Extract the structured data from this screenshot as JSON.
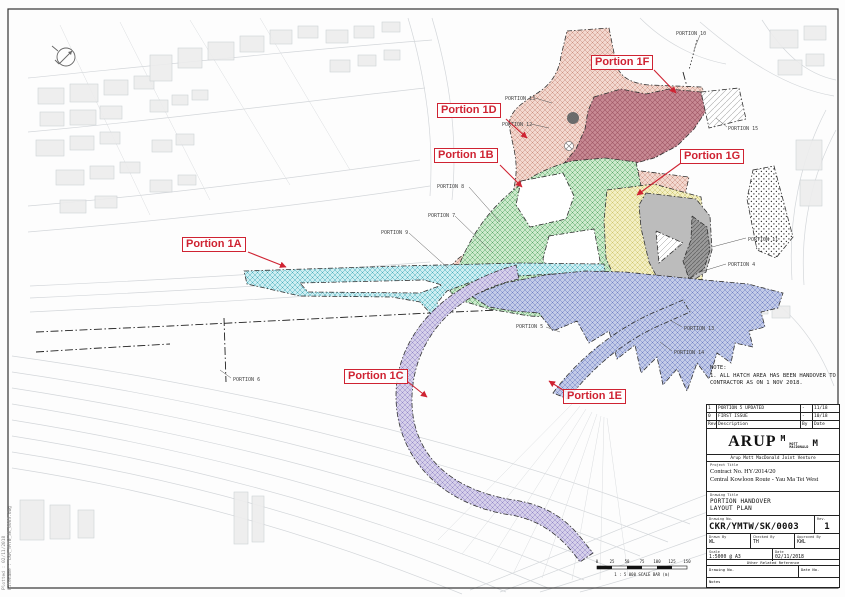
{
  "colors": {
    "annotation_red": "#cf2332",
    "portion_1a_cyan": "#cdeef2",
    "portion_1b_green": "#cdeacc",
    "portion_1c_lavender": "#d6d0ea",
    "portion_1d_salmon": "#f3d8cf",
    "portion_1e_periwinkle": "#c3cbe8",
    "portion_1f_maroon": "#c88a94",
    "portion_1g_yellow": "#f3efc3",
    "portion_4_gray": "#bcbcbc"
  },
  "map": {
    "portion_labels": [
      {
        "text": "Portion 1A"
      },
      {
        "text": "Portion 1B"
      },
      {
        "text": "Portion 1C"
      },
      {
        "text": "Portion 1D"
      },
      {
        "text": "Portion 1E"
      },
      {
        "text": "Portion 1F"
      },
      {
        "text": "Portion 1G"
      }
    ],
    "small_labels": [
      {
        "text": "PORTION 10"
      },
      {
        "text": "PORTION 13"
      },
      {
        "text": "PORTION 12"
      },
      {
        "text": "PORTION 15"
      },
      {
        "text": "PORTION 8"
      },
      {
        "text": "PORTION 7"
      },
      {
        "text": "PORTION 9"
      },
      {
        "text": "PORTION 11"
      },
      {
        "text": "PORTION 4"
      },
      {
        "text": "PORTION 5"
      },
      {
        "text": "PORTION 13"
      },
      {
        "text": "PORTION 14"
      },
      {
        "text": "PORTION 6"
      }
    ]
  },
  "notes": {
    "title": "NOTE:",
    "line1": "1.  ALL HATCH AREA HAS BEEN HANDOVER TO",
    "line2": "    CONTRACTOR AS ON 1 NOV 2018."
  },
  "title_block": {
    "revisions": [
      {
        "rev": "1",
        "description": "PORTION 5 UPDATED",
        "by": "-",
        "date": "11/18"
      },
      {
        "rev": "0",
        "description": "FIRST ISSUE",
        "by": "-",
        "date": "10/18"
      }
    ],
    "rev_headers": {
      "rev": "Rev",
      "description": "Description",
      "by": "By",
      "date": "Date"
    },
    "logo": {
      "arup": "ARUP",
      "m_sup": "M",
      "mott": "MOTT",
      "macdonald": "MACDONALD",
      "m_big": "M",
      "jv": "Arup Mott MacDonald Joint Venture"
    },
    "project": {
      "label": "Project Title",
      "line1": "Contract No. HY/2014/20",
      "line2": "Central Kowloon Route - Yau Ma Tei West"
    },
    "drawing": {
      "label": "Drawing Title",
      "line1": "PORTION HANDOVER",
      "line2": "LAYOUT PLAN"
    },
    "number": {
      "label": "Drawing No.",
      "value": "CKR/YMTW/SK/0003",
      "rev_label": "Rev.",
      "rev": "1"
    },
    "signoff": {
      "drawn_label": "Drawn By",
      "drawn": "WL",
      "checked_label": "Checked By",
      "checked": "TH",
      "approved_label": "Approved By",
      "approved": "KWL"
    },
    "scale": {
      "label": "Scale",
      "value": "1:5000 @ A3",
      "date_label": "Date",
      "date": "02/11/2018"
    },
    "other_ref": "Other Related Reference",
    "ref_row": {
      "left": "Drawing No.",
      "right": "Date No."
    },
    "notes_label": "Notes"
  },
  "scale_bar": {
    "ticks": [
      "0",
      "25",
      "50",
      "75",
      "100",
      "125",
      "150"
    ],
    "caption": "1 : 5 000  SCALE BAR (m)"
  },
  "edge": {
    "line1": "Plotted : 02/11/2018",
    "line2": "Filename : CKR_YMTW_SK_0003.dwg"
  }
}
